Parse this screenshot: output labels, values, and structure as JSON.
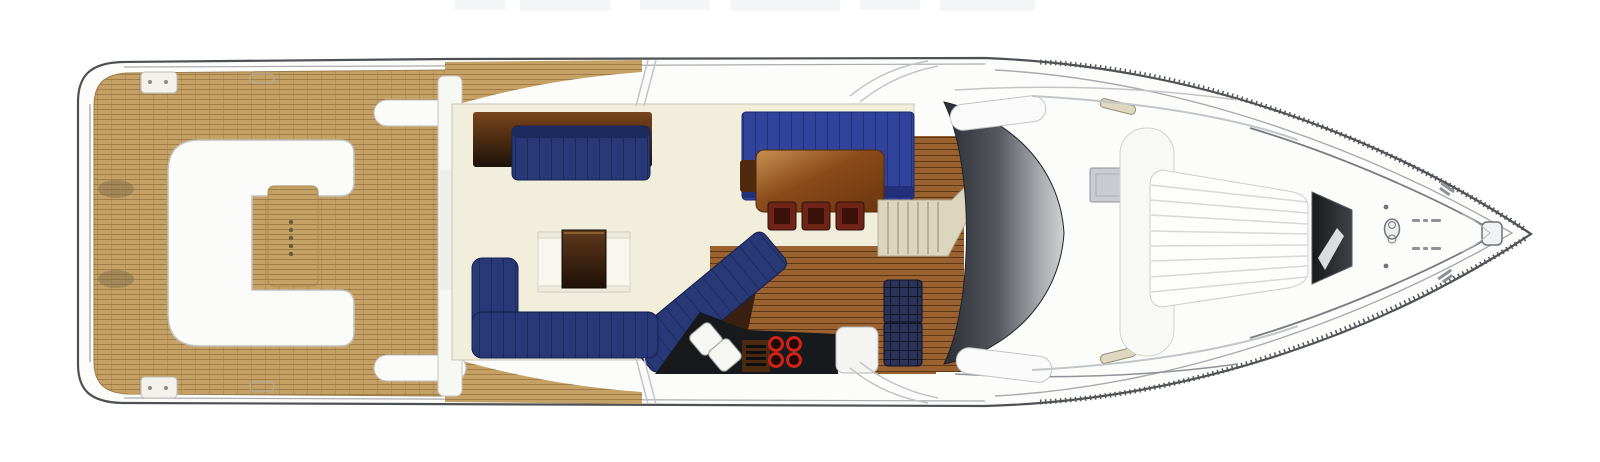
{
  "plan": {
    "kind": "motor-yacht main-deck floor plan, top view",
    "canvas": {
      "width": 1600,
      "height": 462
    },
    "counts": {
      "aft-table-dots": 5,
      "dining-chairs": 3,
      "galley-burners": 4,
      "galley-sinks": 2,
      "galley-grill-bars": 4,
      "checkered-seats": 2,
      "sunpad-seams": 8,
      "stair-treads": 6
    }
  },
  "colors": {
    "hull-fill": "#fcfcfb",
    "hull-line": "#4e5154",
    "hull-inner-line": "#a8abae",
    "teak-base": "#c5a166",
    "teak-line": "#a07e49",
    "teak-seam": "#8f7440",
    "teak-smudge": "#6f6540",
    "cream-floor": "#f2eedc",
    "cream-edge": "#c8c6b4",
    "white-furniture": "#fbfbf9",
    "furniture-stroke": "#c2c2bc",
    "navy-sofa": "#293877",
    "navy-sofa-line": "#1c2a5e",
    "navy-bench": "#31439a",
    "navy-bench-line": "#22307a",
    "wood-dark-top": "#7a451c",
    "wood-dark-bottom": "#1c1208",
    "table-brown-light": "#c89050",
    "table-brown": "#8a4b1b",
    "table-brown-dark": "#6b350f",
    "coffee-top": "#5e3a1c",
    "coffee-bottom": "#1f1006",
    "galley-wood": "#9a6230",
    "galley-wood-line": "#5e3813",
    "counter-black": "#17191c",
    "burner-red": "#cc2218",
    "chair-maroon": "#6e2417",
    "chair-maroon-dark": "#3a120a",
    "check-seat": "#2b3458",
    "check-seat-line": "#101527",
    "stairs-beige": "#ddd6bf",
    "stairs-line": "#a9a289",
    "windshield-dark": "#2b2f35",
    "windshield-mid": "#55595f",
    "windshield-silver": "#a7abae",
    "windshield-light": "#cfd2d4",
    "sunpad-seam": "#d8d8d4",
    "hatch-dark": "#17181a",
    "hatch-mid": "#3f4347",
    "gray-inset": "#c9ccd0",
    "cleat-beige": "#ded8c0",
    "detail-gray": "#9aa0a4",
    "micro-mark": "#8e9296",
    "artifact-gray": "#f3f5f7"
  }
}
